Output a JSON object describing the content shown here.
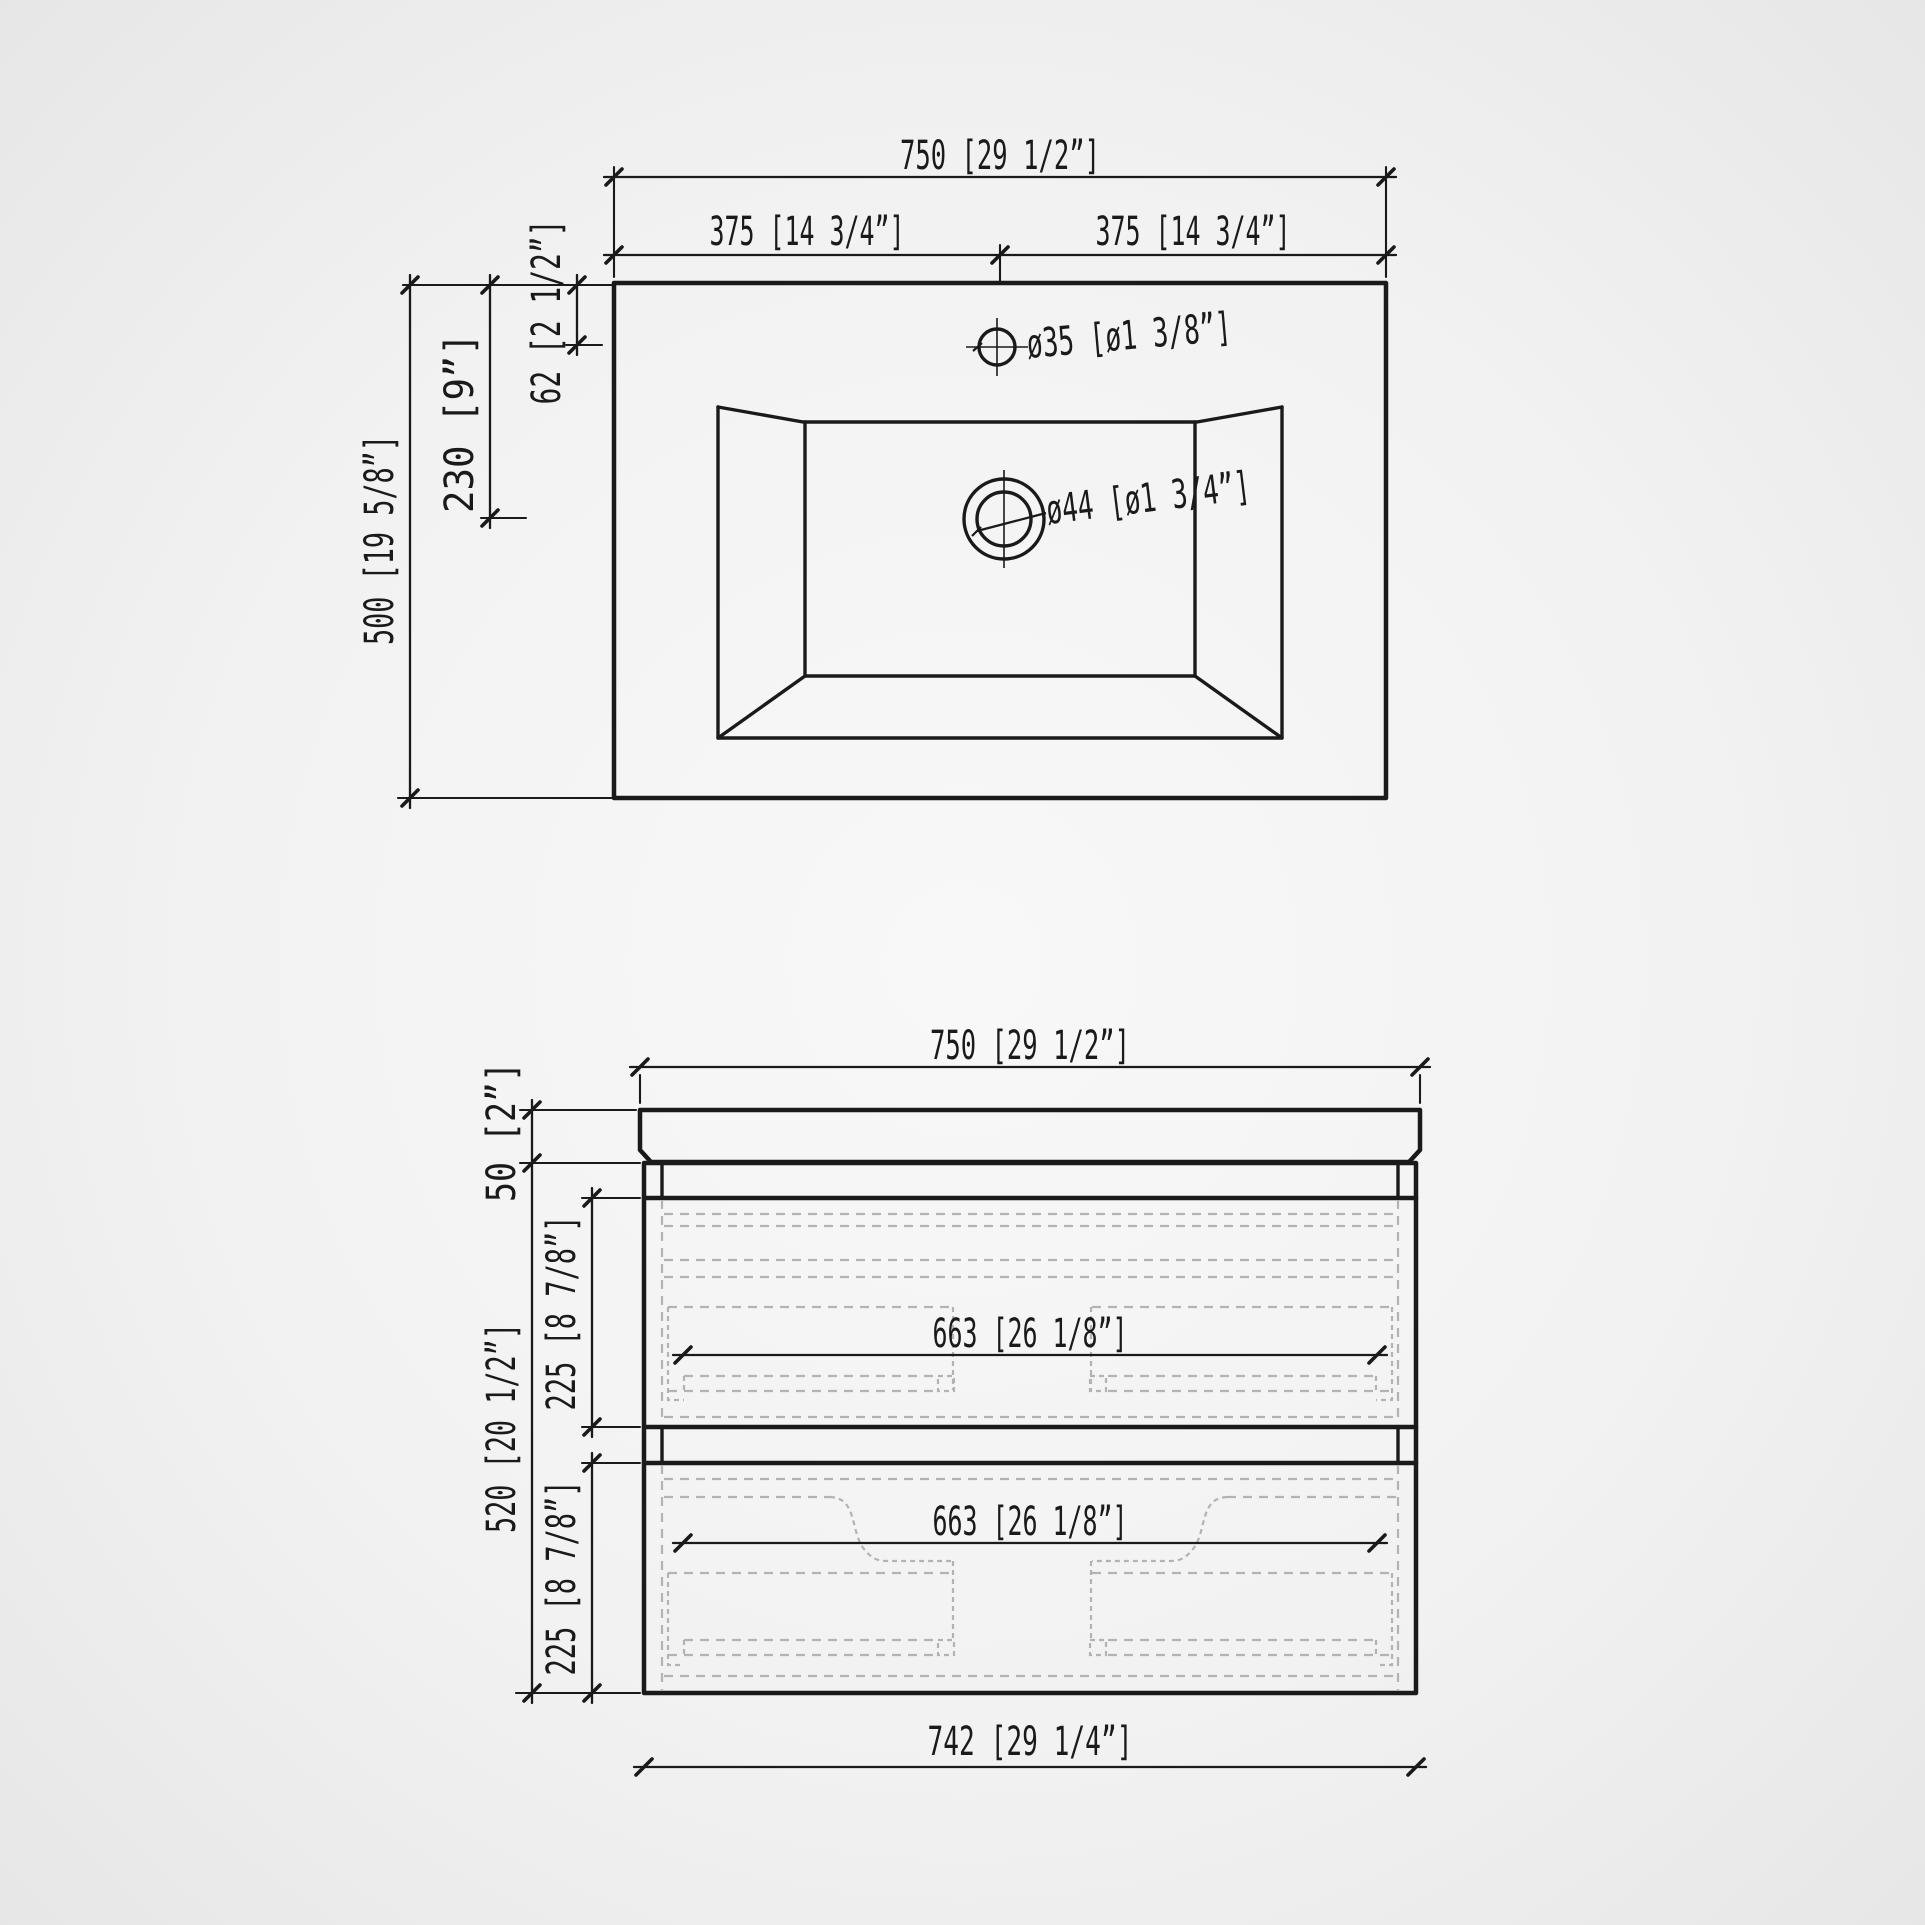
{
  "drawing": {
    "kind": "bathroom vanity technical dimension drawing",
    "colors": {
      "line": "#1a1a1a",
      "hidden_line": "#b3b3b3",
      "background_center": "#f8f8f8",
      "background_edge": "#e6e6e6"
    }
  },
  "top_view": {
    "dim_overall_width": "750 [29 1/2”]",
    "dim_half_width_left": "375 [14 3/4”]",
    "dim_half_width_right": "375 [14 3/4”]",
    "dim_depth": "500 [19 5/8”]",
    "dim_drain_setback": "230 [9”]",
    "dim_faucet_setback": "62 [2 1/2”]",
    "label_faucet_hole": "ø35 [ø1 3/8”]",
    "label_drain_hole": "ø44 [ø1 3/4”]"
  },
  "front_view": {
    "dim_overall_width": "750 [29 1/2”]",
    "dim_countertop_thickness": "50 [2”]",
    "dim_cabinet_height": "520 [20 1/2”]",
    "dim_drawer_top_height": "225 [8 7/8”]",
    "dim_drawer_bottom_height": "225 [8 7/8”]",
    "dim_drawer_top_inner_width": "663 [26 1/8”]",
    "dim_drawer_bottom_inner_width": "663 [26 1/8”]",
    "dim_cabinet_width": "742 [29 1/4”]"
  }
}
